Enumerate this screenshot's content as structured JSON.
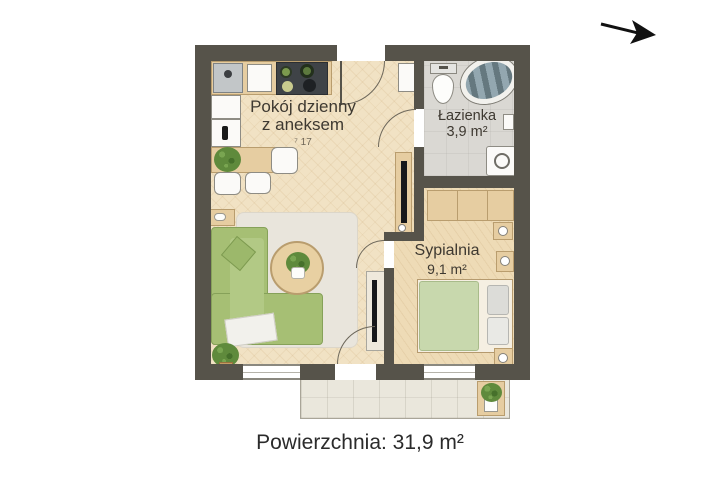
{
  "plan": {
    "rooms": [
      {
        "id": "living",
        "name_line1": "Pokój dzienny",
        "name_line2": "z aneksem",
        "area_note": "⁷ 17"
      },
      {
        "id": "bathroom",
        "name": "Łazienka",
        "area": "3,9 m²"
      },
      {
        "id": "bedroom",
        "name": "Sypialnia",
        "area": "9,1 m²"
      }
    ],
    "furniture": [
      "kitchen-sink",
      "cutting-board",
      "cooktop",
      "upper-cabinet",
      "fridge",
      "dining-table",
      "dining-chairs",
      "side-table",
      "corner-sofa",
      "coffee-table",
      "rug",
      "potted-plant",
      "media-console",
      "tv",
      "wardrobe",
      "bed",
      "nightstand",
      "toilet",
      "bathtub",
      "washing-machine",
      "entry-cabinet",
      "balcony-plant"
    ],
    "north_arrow": "north-arrow"
  },
  "caption": {
    "label": "Powierzchnia: 31,9 m²"
  },
  "colors": {
    "wall": "#56534a",
    "living_floor": "#f1e2c4",
    "bedroom_floor": "#eedbb6",
    "bathroom_floor": "#dad8d3",
    "balcony_floor": "#eae7dc",
    "sofa_green": "#a6bf74",
    "bed_green": "#c8d8ad",
    "furniture_wood": "#e6cda1",
    "text": "#3e3931"
  }
}
